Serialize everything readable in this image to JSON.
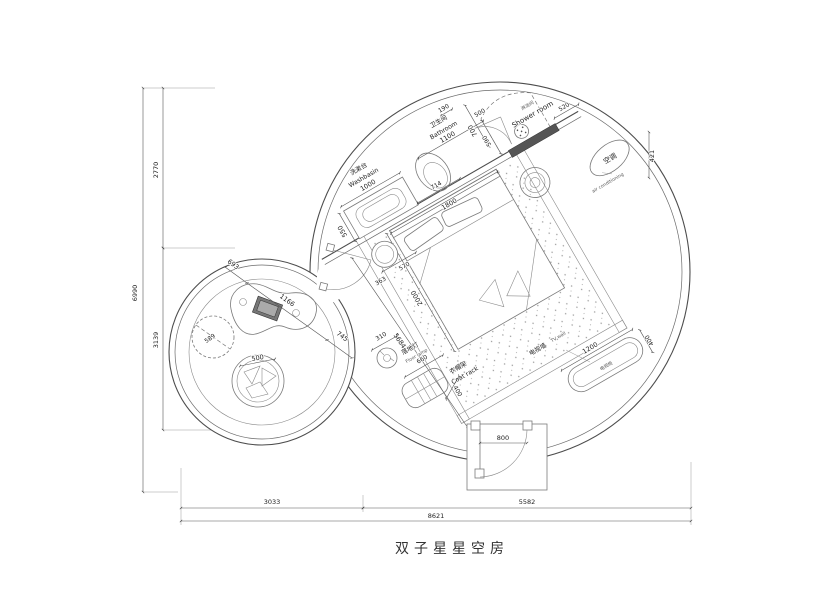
{
  "title": "双子星星空房",
  "plan": {
    "washbasin": {
      "zh": "洗漱台",
      "en": "Washbasin",
      "width": "1000",
      "depth": "550"
    },
    "bathroom": {
      "zh": "卫生间",
      "en": "Bathroom",
      "width": "1100",
      "wall": "190",
      "depth": "700",
      "gap": "590",
      "toilet": "714"
    },
    "shower": {
      "zh": "淋浴间",
      "en": "Shower room",
      "door": "500",
      "side": "520"
    },
    "aircon": {
      "zh": "空调",
      "en": "air conditioning",
      "depth": "421"
    },
    "bed": {
      "width": "1800",
      "length": "2000",
      "stool_a": "363",
      "stool_b": "570",
      "diagonal": "5684"
    },
    "tv": {
      "wall_zh": "电视墙",
      "wall_en": "TV wall",
      "cabinet_zh": "电视柜",
      "cabinet_w": "1200",
      "cabinet_d": "400"
    },
    "lamp": {
      "zh": "落地灯",
      "en": "Floor lamp",
      "dim": "310"
    },
    "rack": {
      "zh": "衣帽架",
      "en": "Coat rack",
      "width": "660",
      "depth": "400"
    },
    "entry": {
      "door": "800"
    },
    "lounge": {
      "seg1": "693",
      "seg2": "1166",
      "seg3": "745",
      "bean": "589",
      "seat": "500"
    }
  },
  "dims": {
    "left": {
      "overall": "6990",
      "top": "2770",
      "bottom": "3139"
    },
    "bottom": {
      "left": "3033",
      "right": "5582",
      "overall": "8621"
    }
  }
}
